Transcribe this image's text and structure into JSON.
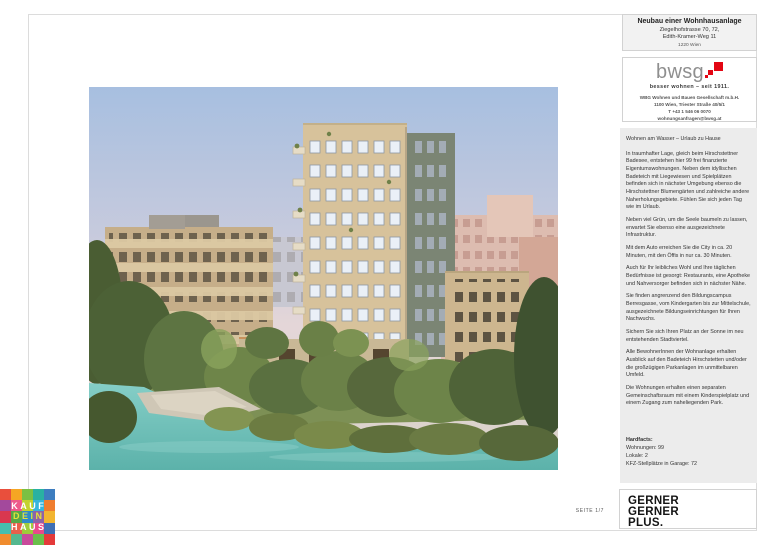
{
  "header": {
    "title": "Neubau einer Wohnhausanlage",
    "address_line1": "Ziegelhofstrasse 70, 72,",
    "address_line2": "Edith-Kramer-Weg 11",
    "address_line3": "1220 Wien"
  },
  "bwsg": {
    "wordmark": "bwsg",
    "tagline": "besser wohnen – seit 1911.",
    "company": "WBG Wohnen und Bauen Gesellschaft m.b.H.",
    "address": "1100 Wien, Triester Straße 40/5/1",
    "phone": "T +43 1 546 06 0070",
    "email": "wohnungsanfragen@bwsg.at"
  },
  "description": {
    "headline": "Wohnen am Wasser – Urlaub zu Hause",
    "paragraphs": [
      "In traumhafter Lage, gleich beim Hirschstettner Badesee, entstehen hier 99 frei finanzierte Eigentumswohnungen. Neben dem idyllischen Badeteich mit Liegewiesen und Spielplätzen befinden sich in nächster Umgebung ebenso die Hirschstettner Blumengärten und zahlreiche andere Naherholungsgebiete. Fühlen Sie sich jeden Tag wie im Urlaub.",
      "Neben viel Grün, um die Seele baumeln zu lassen, erwartet Sie ebenso eine ausgezeichnete Infrastruktur.",
      "Mit dem Auto erreichen Sie die City in ca. 20 Minuten, mit den Öffis in nur ca. 30 Minuten.",
      "Auch für Ihr leibliches Wohl und Ihre täglichen Bedürfnisse ist gesorgt: Restaurants, eine Apotheke und Nahversorger befinden sich in nächster Nähe.",
      "Sie finden angrenzend den Bildungscampus Berresgasse, vom Kindergarten bis zur Mittelschule, ausgezeichnete Bildungseinrichtungen für Ihren Nachwuchs.",
      "Sichern Sie sich Ihren Platz an der Sonne im neu entstehenden Stadtviertel.",
      "Alle BewohnerInnen der Wohnanlage erhalten Ausblick auf den Badeteich Hirschstetten und/oder die großzügigen Parkanlagen im unmittelbaren Umfeld.",
      "Die Wohnungen erhalten einen separaten Gemeinschaftsraum mit einem Kinderspielplatz und einem Zugang zum naheliegenden Park."
    ]
  },
  "hardfacts": {
    "heading": "Hardfacts:",
    "items": [
      "Wohnungen: 99",
      "Lokale: 2",
      "KFZ-Stellplätze in Garage: 72"
    ]
  },
  "architect_logo": {
    "lines": [
      "GERNER",
      "GERNER",
      "PLUS."
    ]
  },
  "footer": {
    "page_label": "SEITE 1/7"
  },
  "kaufdeinhaus": {
    "lines": [
      "KAUF",
      "DEIN",
      "HAUS"
    ],
    "dein_color": "#e3e23a",
    "tile_colors": [
      "#e94f3c",
      "#f5a623",
      "#7bc043",
      "#29b1a2",
      "#3d7dbf",
      "#a3499c",
      "#ee5a8b",
      "#c3d22e",
      "#36b5dd",
      "#ef7d2f",
      "#d9374f",
      "#57a749",
      "#2f8ac9",
      "#8e62a8",
      "#f2b530",
      "#45bfae",
      "#e8604c",
      "#9fcc3b",
      "#e84a8a",
      "#3f6fb5",
      "#f08c2e",
      "#55b88f",
      "#c84b9b",
      "#6abf4b",
      "#e43a3a"
    ]
  },
  "colors": {
    "bwsg_red": "#e30613"
  }
}
